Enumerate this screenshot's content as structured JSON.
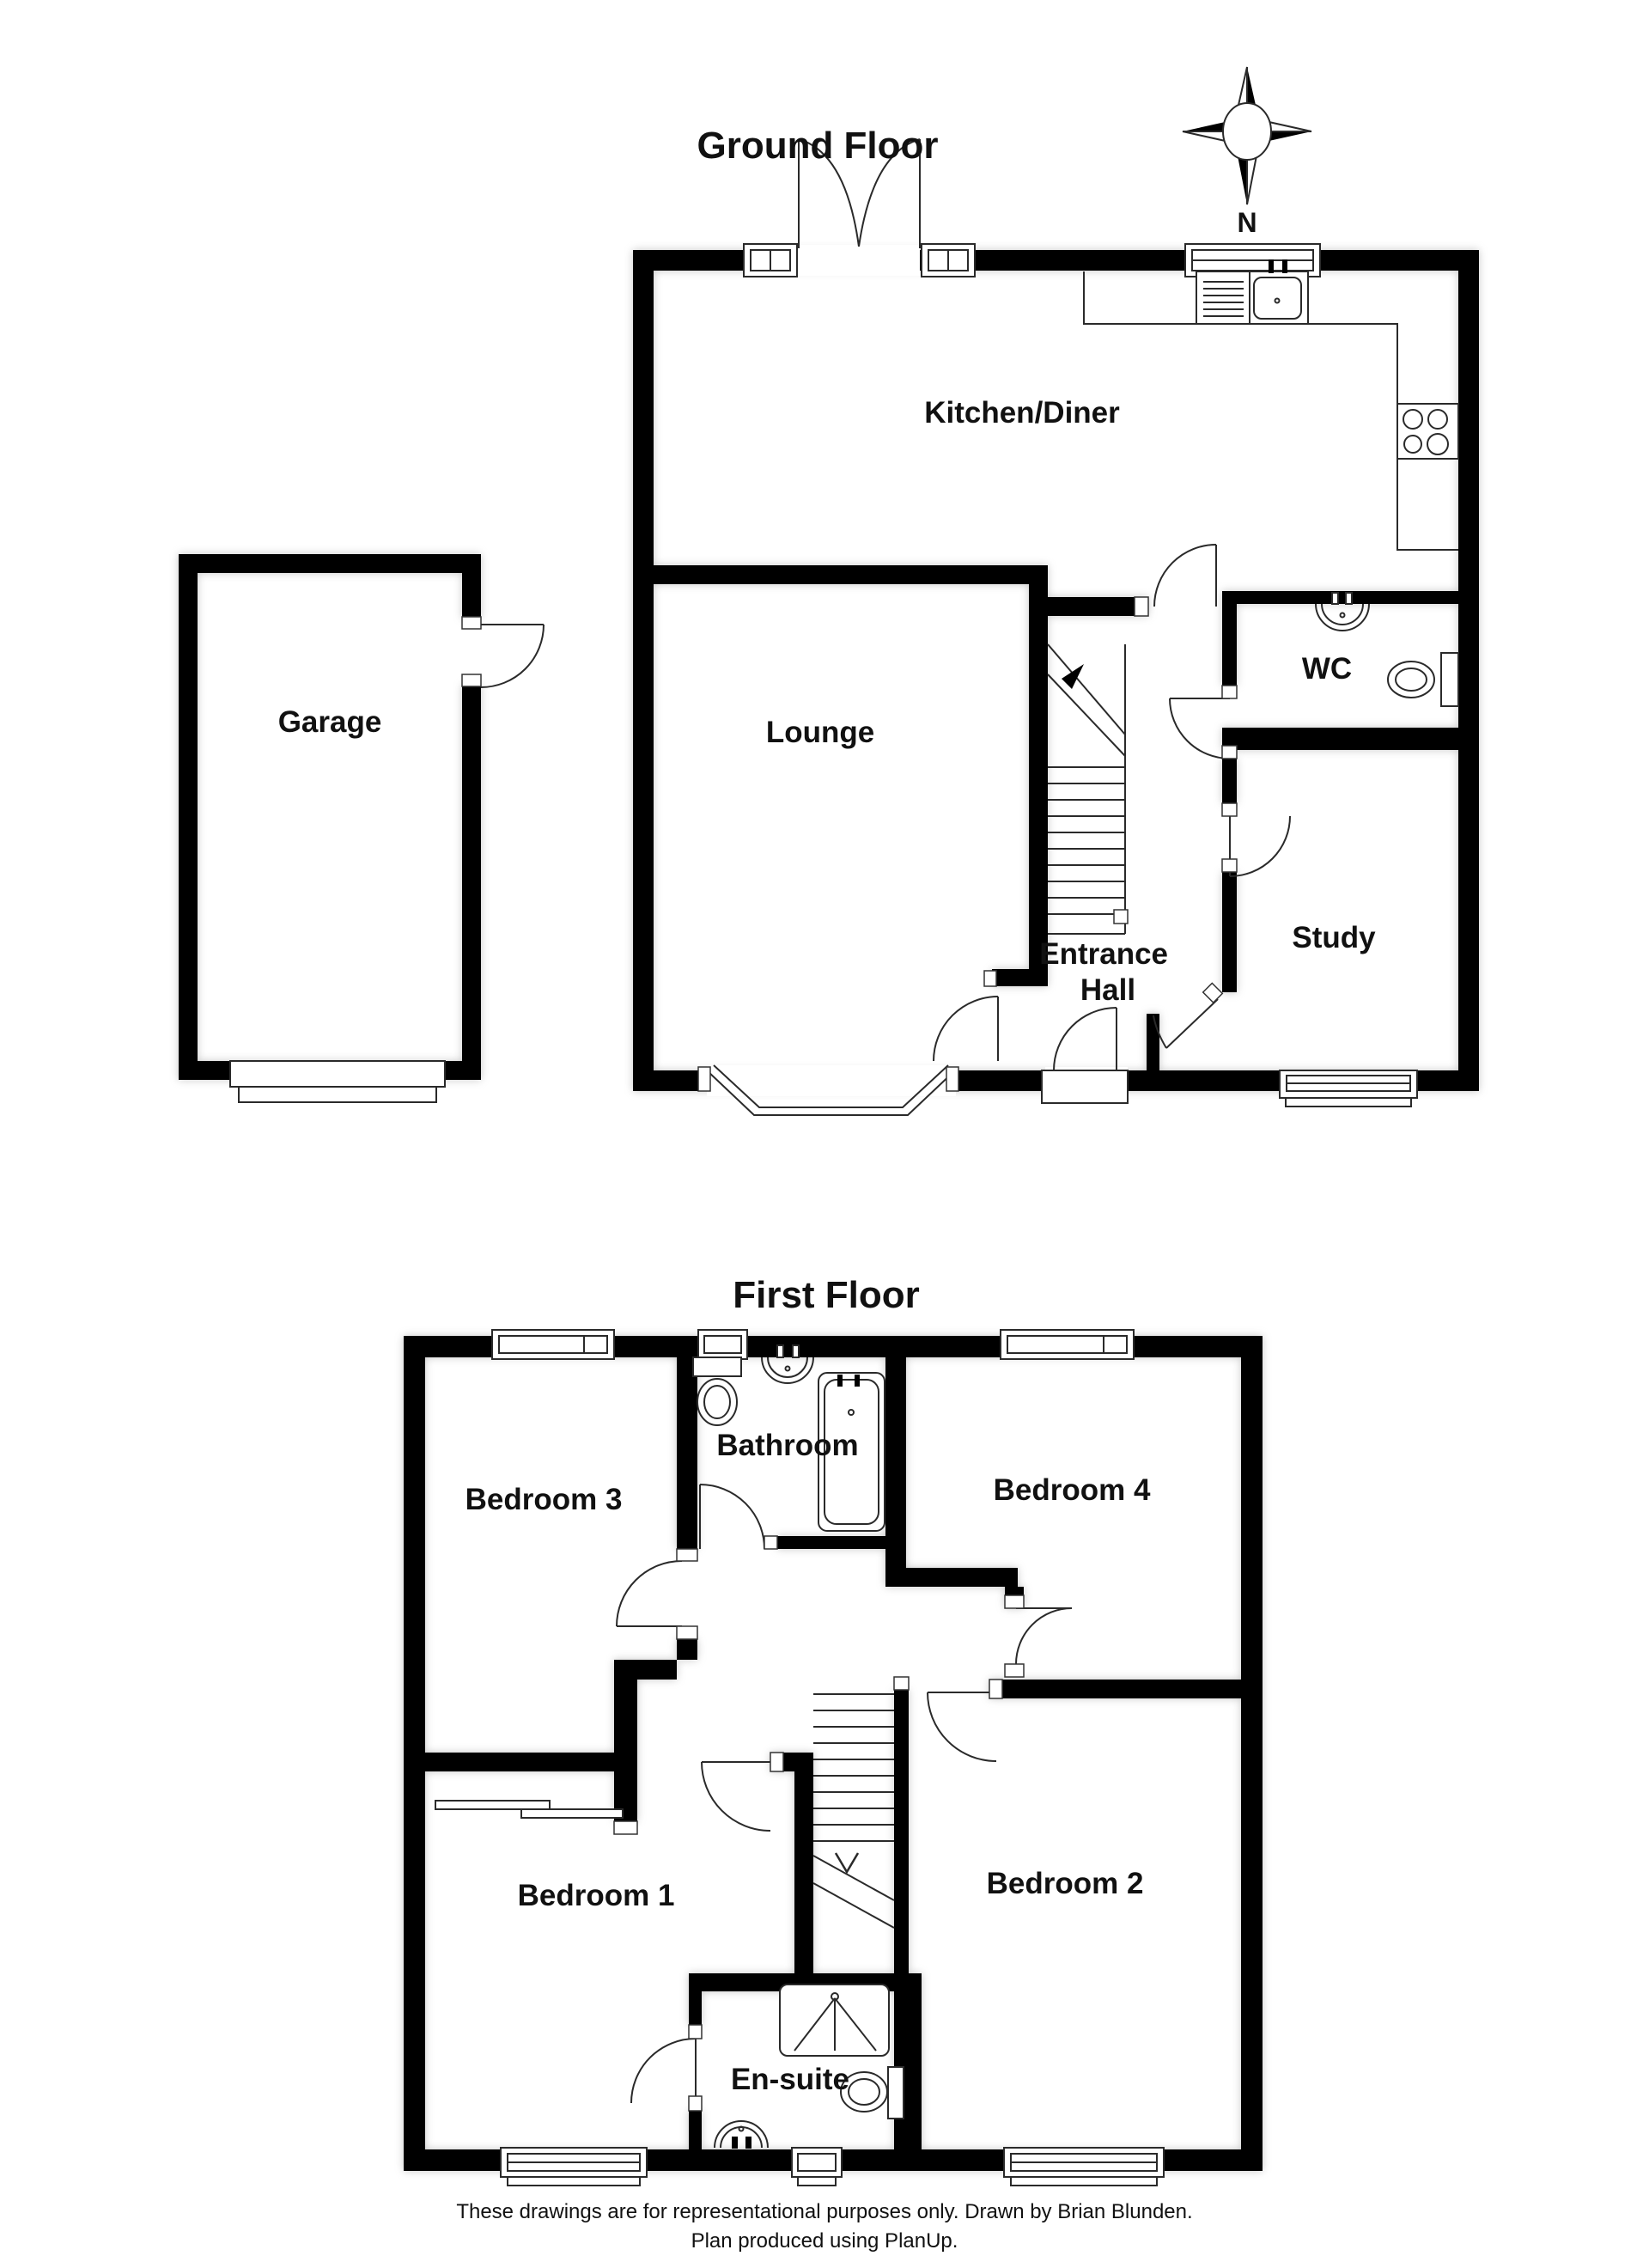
{
  "document": {
    "type": "floor-plan"
  },
  "ground_floor": {
    "title": "Ground Floor",
    "compass_label": "N",
    "rooms": [
      "Kitchen/Diner",
      "Garage",
      "Lounge",
      "WC",
      "Entrance Hall",
      "Study"
    ],
    "labels": {
      "kitchen_diner": "Kitchen/Diner",
      "garage": "Garage",
      "lounge": "Lounge",
      "wc": "WC",
      "entrance_hall_line1": "Entrance",
      "entrance_hall_line2": "Hall",
      "study": "Study"
    }
  },
  "first_floor": {
    "title": "First Floor",
    "rooms": [
      "Bedroom 3",
      "Bathroom",
      "Bedroom 4",
      "Bedroom 1",
      "Bedroom 2",
      "En-suite"
    ],
    "labels": {
      "bedroom3": "Bedroom 3",
      "bathroom": "Bathroom",
      "bedroom4": "Bedroom 4",
      "bedroom1": "Bedroom 1",
      "bedroom2": "Bedroom 2",
      "ensuite": "En-suite"
    }
  },
  "footer": {
    "line1": "These drawings are for representational purposes only. Drawn by Brian Blunden.",
    "line2": "Plan produced using PlanUp."
  },
  "colors": {
    "wall": "#000000",
    "line": "#2a2a2a",
    "background": "#ffffff"
  }
}
